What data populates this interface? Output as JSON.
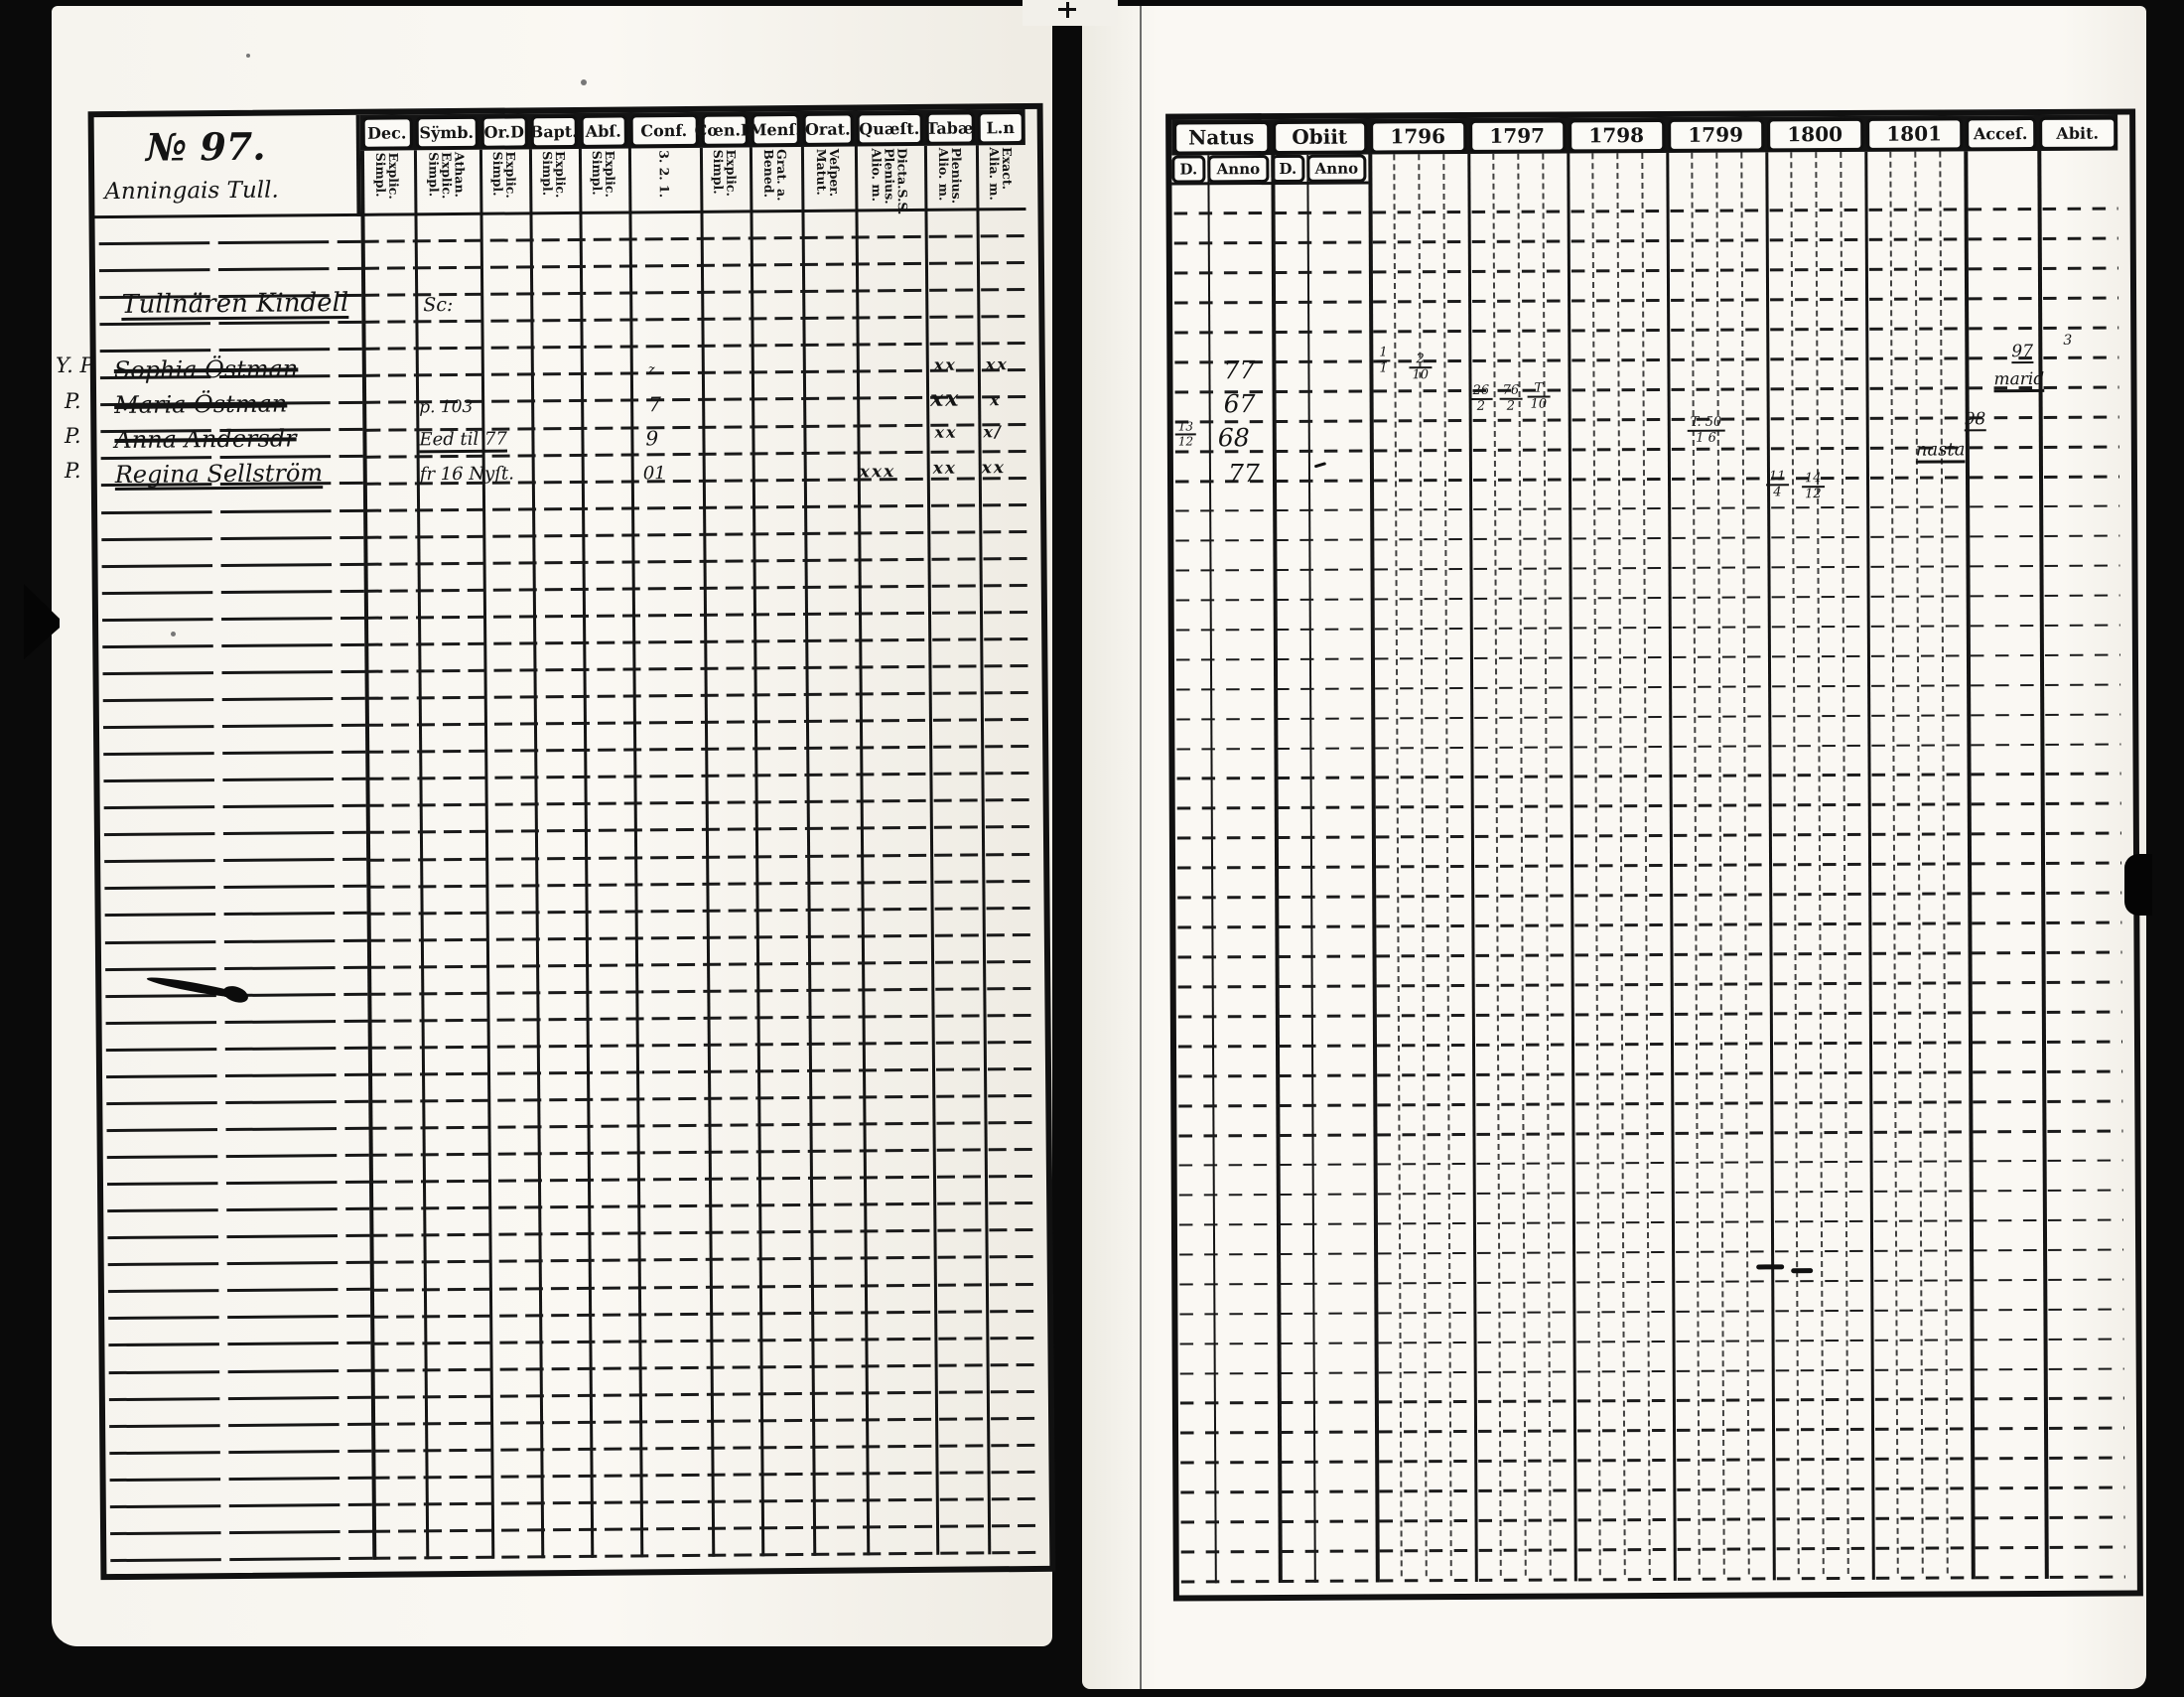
{
  "left_page": {
    "number_label": "№ 97.",
    "place": "Anningais Tull.",
    "occupant": "Tullnären Kindell",
    "symb_note": "Sc:",
    "columns": [
      {
        "label": "Dec.",
        "sub": "Explic.\nSimpl."
      },
      {
        "label": "Sÿmb.",
        "sub": "Athan.\nExplic.\nSimpl."
      },
      {
        "label": "Or.D",
        "sub": "Explic.\nSimpl."
      },
      {
        "label": "Bapt.",
        "sub": "Explic.\nSimpl."
      },
      {
        "label": "Abſ.",
        "sub": "Explic.\nSimpl."
      },
      {
        "label": "Conf.",
        "sub": "3. 2. 1."
      },
      {
        "label": "Cœn.D",
        "sub": "Explic.\nSimpl."
      },
      {
        "label": "Menſ.",
        "sub": "Grat. a.\nBened."
      },
      {
        "label": "Orat.",
        "sub": "Veſper.\nMatut."
      },
      {
        "label": "Quæſt.",
        "sub": "Dicta.S.S.\nPlenius.\nAlio. m."
      },
      {
        "label": "Tabæ",
        "sub": "Plenius.\nAlio. m."
      },
      {
        "label": "L.n",
        "sub": "Exact.\nAlia. m."
      }
    ],
    "margin_marks": [
      "Y. P.",
      "P.",
      "P.",
      "P."
    ],
    "entries": [
      {
        "name": "Sophia Östman",
        "symb": "",
        "conf": "z",
        "quaest": "",
        "tabae": "xx",
        "ln": "xx"
      },
      {
        "name": "Maria Östman",
        "symb": "p. 103",
        "conf": "7",
        "quaest": "",
        "tabae": "xx",
        "ln": "x"
      },
      {
        "name": "Anna Andersdr",
        "symb": "Eed til 77",
        "conf": "9",
        "quaest": "",
        "tabae": "xx",
        "ln": "x/"
      },
      {
        "name": "Regina Sellström",
        "symb": "fr 16 Nyſt.",
        "conf": "01",
        "quaest": "xxx",
        "tabae": "xx",
        "ln": "xx"
      }
    ]
  },
  "right_page": {
    "natus_label": "Natus",
    "obiit_label": "Obiit",
    "day_label": "D.",
    "anno_label": "Anno",
    "years": [
      "1796",
      "1797",
      "1798",
      "1799",
      "1800",
      "1801"
    ],
    "acces_label": "Acceſ.",
    "abit_label": "Abit.",
    "annos": [
      "77",
      "67",
      "68",
      "77"
    ],
    "marks": {
      "natus_day_r3": {
        "top": "13",
        "bot": "12"
      },
      "y1796_r1": [
        {
          "top": "1",
          "bot": "1"
        },
        {
          "top": "2",
          "bot": "10"
        }
      ],
      "y1797_r2": [
        {
          "top": "26",
          "bot": "2"
        },
        {
          "top": "76",
          "bot": "2"
        },
        {
          "top": "T",
          "bot": "10"
        }
      ],
      "y1799_r3": {
        "top": "T. 50",
        "bot": "1 6"
      },
      "y1800_r4": [
        {
          "top": "11",
          "bot": "4"
        },
        {
          "top": "14",
          "bot": "12"
        }
      ],
      "acces_r1": {
        "num": "97",
        "sup": "3",
        "note": "marid"
      },
      "acces_r3": {
        "num": "98",
        "note": "nasta"
      }
    }
  }
}
